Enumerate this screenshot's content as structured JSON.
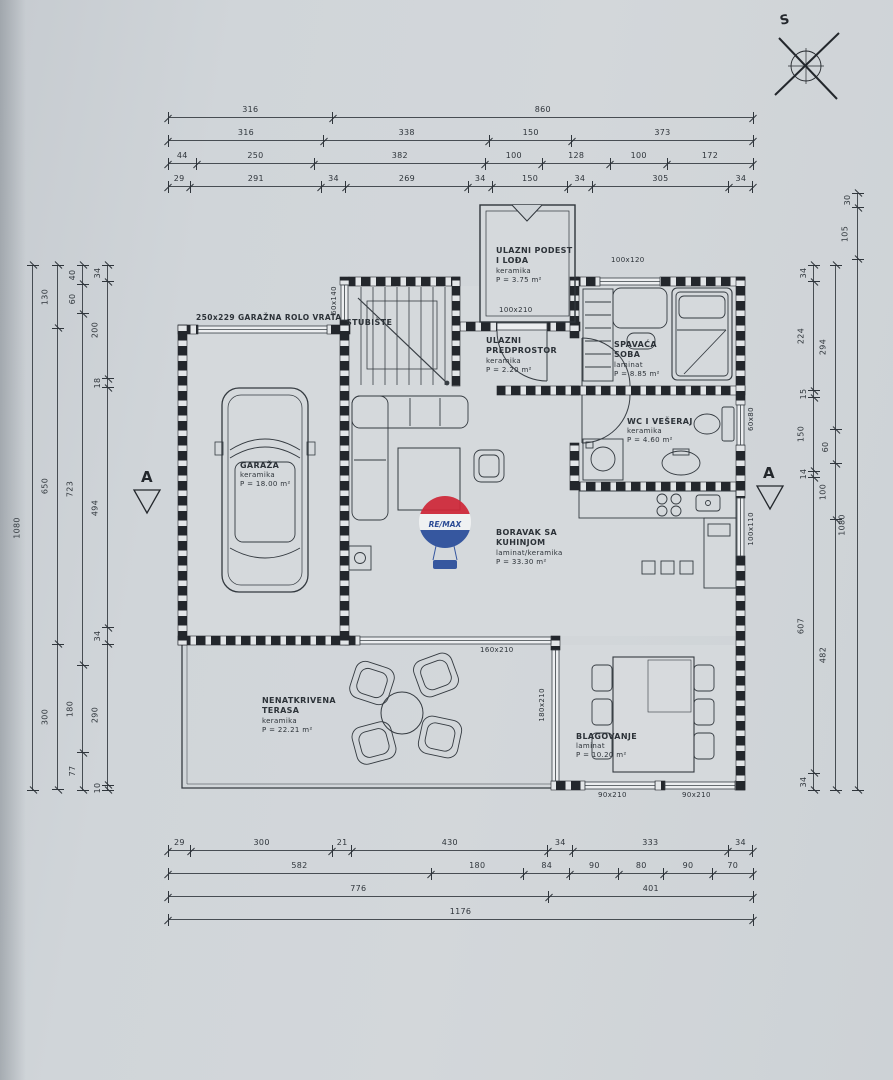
{
  "surface": {
    "paper": "#cfd4d8",
    "ink": "#2f353b",
    "wall": "#22262a"
  },
  "compass": {
    "label": "S"
  },
  "watermark": {
    "brand": "RE/MAX",
    "red": "#cf2839",
    "blue": "#2a4e9b"
  },
  "section": {
    "label": "A"
  },
  "dims": {
    "top": [
      [
        "316",
        "860"
      ],
      [
        "316",
        "338",
        "150",
        "373"
      ],
      [
        "44",
        "250",
        "382",
        "100",
        "128",
        "100",
        "172"
      ],
      [
        "29",
        "291",
        "34",
        "269",
        "34",
        "150",
        "34",
        "305",
        "34"
      ]
    ],
    "bottom": [
      [
        "29",
        "300",
        "21",
        "430",
        "34",
        "333",
        "34"
      ],
      [
        "582",
        "180",
        "84",
        "90",
        "80",
        "90",
        "70"
      ],
      [
        "776",
        "401"
      ],
      [
        "1176"
      ]
    ],
    "left": [
      [
        "1080"
      ],
      [
        "130",
        "650",
        "300"
      ],
      [
        "40",
        "60",
        "723",
        "180",
        "77"
      ],
      [
        "34",
        "200",
        "18",
        "494",
        "34",
        "290",
        "10"
      ]
    ],
    "right": [
      [
        "34",
        "224",
        "15",
        "150",
        "14",
        "607",
        "34"
      ],
      [
        "294",
        "60",
        "100",
        "482"
      ],
      [
        "30",
        "105",
        "1080"
      ]
    ]
  },
  "rooms": {
    "podest": {
      "l1": "ULAZNI PODEST",
      "l2": "I LOĐA",
      "floor": "keramika",
      "area": "P = 3.75 m²"
    },
    "stubiste": {
      "l1": "STUBIŠTE"
    },
    "predprostor": {
      "l1": "ULAZNI",
      "l2": "PREDPROSTOR",
      "floor": "keramika",
      "area": "P = 2.20 m²"
    },
    "spavaca": {
      "l1": "SPAVAĆA",
      "l2": "SOBA",
      "floor": "laminat",
      "area": "P = 8.85 m²"
    },
    "wc": {
      "l1": "WC I VEŠERAJ",
      "floor": "keramika",
      "area": "P = 4.60 m²"
    },
    "garaza": {
      "l1": "GARAŽA",
      "floor": "keramika",
      "area": "P = 18.00 m²"
    },
    "boravak": {
      "l1": "BORAVAK SA",
      "l2": "KUHINJOM",
      "floor": "laminat/keramika",
      "area": "P = 33.30 m²"
    },
    "terasa": {
      "l1": "NENATKRIVENA",
      "l2": "TERASA",
      "floor": "keramika",
      "area": "P = 22.21 m²"
    },
    "blagovanje": {
      "l1": "BLAGOVANJE",
      "floor": "laminat",
      "area": "P = 10.20 m²"
    }
  },
  "openings": {
    "garage_door": "250x229 GARAŽNA ROLO VRATA",
    "entry_door": "100x210",
    "bedroom_window": "100x120",
    "stairs_window": "60x140",
    "wc_window": "60x80",
    "kitchen_window": "100x110",
    "living_window": "160x210",
    "dining_west_window": "180x210",
    "dining_window_a": "90x210",
    "dining_window_b": "90x210"
  }
}
